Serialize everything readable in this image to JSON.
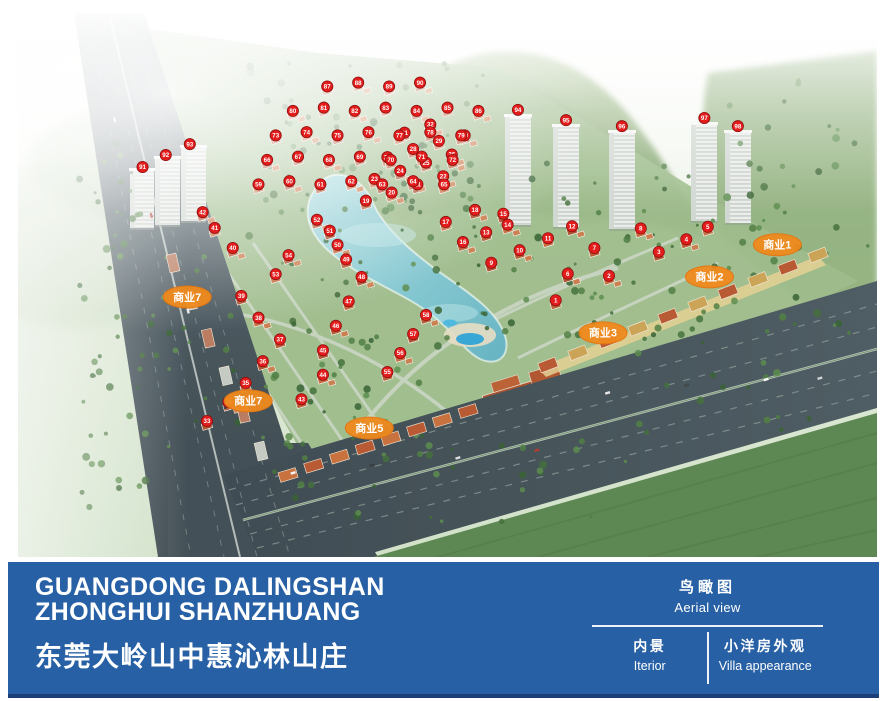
{
  "colors": {
    "footer_bar": "#2760a4",
    "footer_accent": "#1c3f77",
    "marker_red": "#e31c1c",
    "commercial_orange": "#f08a1d"
  },
  "footer": {
    "title_en_line1": "GUANGDONG DALINGSHAN",
    "title_en_line2": "ZHONGHUI SHANZHUANG",
    "title_cn": "东莞大岭山中惠沁林山庄",
    "panel": {
      "top_cn": "鸟瞰图",
      "top_en": "Aerial view",
      "cell1_cn": "内景",
      "cell1_en": "Iterior",
      "cell2_cn": "小洋房外观",
      "cell2_en": "Villa appearance"
    }
  },
  "map": {
    "commercial_labels": [
      {
        "text": "商业1",
        "x": 88.4,
        "y": 42.6
      },
      {
        "text": "商业2",
        "x": 80.5,
        "y": 48.5
      },
      {
        "text": "商业3",
        "x": 68.1,
        "y": 58.8
      },
      {
        "text": "商业5",
        "x": 40.9,
        "y": 76.3
      },
      {
        "text": "商业7",
        "x": 26.8,
        "y": 71.3
      },
      {
        "text": "商业7",
        "x": 19.7,
        "y": 52.2
      }
    ],
    "unit_markers": [
      {
        "n": "1",
        "x": 62.6,
        "y": 52.8
      },
      {
        "n": "2",
        "x": 68.8,
        "y": 48.3
      },
      {
        "n": "3",
        "x": 74.6,
        "y": 43.9
      },
      {
        "n": "4",
        "x": 77.8,
        "y": 41.6
      },
      {
        "n": "5",
        "x": 80.3,
        "y": 39.3
      },
      {
        "n": "6",
        "x": 64.0,
        "y": 47.9
      },
      {
        "n": "7",
        "x": 67.1,
        "y": 43.2
      },
      {
        "n": "8",
        "x": 72.5,
        "y": 39.6
      },
      {
        "n": "9",
        "x": 55.1,
        "y": 45.9
      },
      {
        "n": "10",
        "x": 58.4,
        "y": 43.6
      },
      {
        "n": "11",
        "x": 61.7,
        "y": 41.4
      },
      {
        "n": "12",
        "x": 64.5,
        "y": 39.2
      },
      {
        "n": "13",
        "x": 54.5,
        "y": 40.3
      },
      {
        "n": "14",
        "x": 57.0,
        "y": 38.9
      },
      {
        "n": "15",
        "x": 56.5,
        "y": 36.9
      },
      {
        "n": "16",
        "x": 51.8,
        "y": 42.1
      },
      {
        "n": "17",
        "x": 49.8,
        "y": 38.4
      },
      {
        "n": "18",
        "x": 53.2,
        "y": 36.2
      },
      {
        "n": "19",
        "x": 40.5,
        "y": 34.5
      },
      {
        "n": "20",
        "x": 43.5,
        "y": 33.0
      },
      {
        "n": "21",
        "x": 46.5,
        "y": 31.5
      },
      {
        "n": "22",
        "x": 49.5,
        "y": 30.0
      },
      {
        "n": "23",
        "x": 41.5,
        "y": 30.5
      },
      {
        "n": "24",
        "x": 44.5,
        "y": 29.0
      },
      {
        "n": "25",
        "x": 47.5,
        "y": 27.5
      },
      {
        "n": "26",
        "x": 50.5,
        "y": 26.0
      },
      {
        "n": "27",
        "x": 43.0,
        "y": 26.5
      },
      {
        "n": "28",
        "x": 46.0,
        "y": 25.0
      },
      {
        "n": "29",
        "x": 49.0,
        "y": 23.5
      },
      {
        "n": "30",
        "x": 52.0,
        "y": 22.5
      },
      {
        "n": "31",
        "x": 45.0,
        "y": 22.0
      },
      {
        "n": "32",
        "x": 48.0,
        "y": 20.5
      },
      {
        "n": "33",
        "x": 22.0,
        "y": 75.0
      },
      {
        "n": "34",
        "x": 24.5,
        "y": 71.5
      },
      {
        "n": "35",
        "x": 26.5,
        "y": 68.0
      },
      {
        "n": "36",
        "x": 28.5,
        "y": 64.0
      },
      {
        "n": "37",
        "x": 30.5,
        "y": 60.0
      },
      {
        "n": "38",
        "x": 28.0,
        "y": 56.0
      },
      {
        "n": "39",
        "x": 26.0,
        "y": 52.0
      },
      {
        "n": "40",
        "x": 25.0,
        "y": 43.2
      },
      {
        "n": "41",
        "x": 22.9,
        "y": 39.5
      },
      {
        "n": "42",
        "x": 21.5,
        "y": 36.6
      },
      {
        "n": "43",
        "x": 33.0,
        "y": 71.0
      },
      {
        "n": "44",
        "x": 35.5,
        "y": 66.5
      },
      {
        "n": "45",
        "x": 35.5,
        "y": 62.0
      },
      {
        "n": "46",
        "x": 37.0,
        "y": 57.5
      },
      {
        "n": "47",
        "x": 38.5,
        "y": 53.0
      },
      {
        "n": "48",
        "x": 40.0,
        "y": 48.5
      },
      {
        "n": "49",
        "x": 38.2,
        "y": 45.3
      },
      {
        "n": "50",
        "x": 37.2,
        "y": 42.6
      },
      {
        "n": "51",
        "x": 36.3,
        "y": 40.0
      },
      {
        "n": "52",
        "x": 34.8,
        "y": 38.0
      },
      {
        "n": "53",
        "x": 30.0,
        "y": 48.0
      },
      {
        "n": "54",
        "x": 31.5,
        "y": 44.5
      },
      {
        "n": "55",
        "x": 43.0,
        "y": 66.0
      },
      {
        "n": "56",
        "x": 44.5,
        "y": 62.5
      },
      {
        "n": "57",
        "x": 46.0,
        "y": 59.0
      },
      {
        "n": "58",
        "x": 47.5,
        "y": 55.5
      },
      {
        "n": "59",
        "x": 28.0,
        "y": 31.5
      },
      {
        "n": "60",
        "x": 31.6,
        "y": 30.9
      },
      {
        "n": "61",
        "x": 35.2,
        "y": 31.5
      },
      {
        "n": "62",
        "x": 38.8,
        "y": 30.9
      },
      {
        "n": "63",
        "x": 42.4,
        "y": 31.5
      },
      {
        "n": "64",
        "x": 46.0,
        "y": 30.9
      },
      {
        "n": "65",
        "x": 49.6,
        "y": 31.5
      },
      {
        "n": "66",
        "x": 29.0,
        "y": 27.0
      },
      {
        "n": "67",
        "x": 32.6,
        "y": 26.4
      },
      {
        "n": "68",
        "x": 36.2,
        "y": 27.0
      },
      {
        "n": "69",
        "x": 39.8,
        "y": 26.4
      },
      {
        "n": "70",
        "x": 43.4,
        "y": 27.0
      },
      {
        "n": "71",
        "x": 47.0,
        "y": 26.4
      },
      {
        "n": "72",
        "x": 50.6,
        "y": 27.0
      },
      {
        "n": "73",
        "x": 30.0,
        "y": 22.5
      },
      {
        "n": "74",
        "x": 33.6,
        "y": 21.9
      },
      {
        "n": "75",
        "x": 37.2,
        "y": 22.5
      },
      {
        "n": "76",
        "x": 40.8,
        "y": 21.9
      },
      {
        "n": "77",
        "x": 44.4,
        "y": 22.5
      },
      {
        "n": "78",
        "x": 48.0,
        "y": 21.9
      },
      {
        "n": "79",
        "x": 51.6,
        "y": 22.5
      },
      {
        "n": "80",
        "x": 32.0,
        "y": 18.0
      },
      {
        "n": "81",
        "x": 35.6,
        "y": 17.4
      },
      {
        "n": "82",
        "x": 39.2,
        "y": 18.0
      },
      {
        "n": "83",
        "x": 42.8,
        "y": 17.4
      },
      {
        "n": "84",
        "x": 46.4,
        "y": 18.0
      },
      {
        "n": "85",
        "x": 50.0,
        "y": 17.4
      },
      {
        "n": "86",
        "x": 53.6,
        "y": 18.0
      },
      {
        "n": "87",
        "x": 36.0,
        "y": 13.5
      },
      {
        "n": "88",
        "x": 39.6,
        "y": 12.8
      },
      {
        "n": "89",
        "x": 43.2,
        "y": 13.5
      },
      {
        "n": "90",
        "x": 46.8,
        "y": 12.8
      },
      {
        "n": "91",
        "x": 14.5,
        "y": 28.3
      },
      {
        "n": "92",
        "x": 17.2,
        "y": 26.1
      },
      {
        "n": "93",
        "x": 20.0,
        "y": 24.1
      },
      {
        "n": "94",
        "x": 58.2,
        "y": 17.8
      },
      {
        "n": "95",
        "x": 63.8,
        "y": 19.7
      },
      {
        "n": "96",
        "x": 70.3,
        "y": 20.8
      },
      {
        "n": "97",
        "x": 79.9,
        "y": 19.3
      },
      {
        "n": "98",
        "x": 83.8,
        "y": 20.8
      }
    ]
  }
}
